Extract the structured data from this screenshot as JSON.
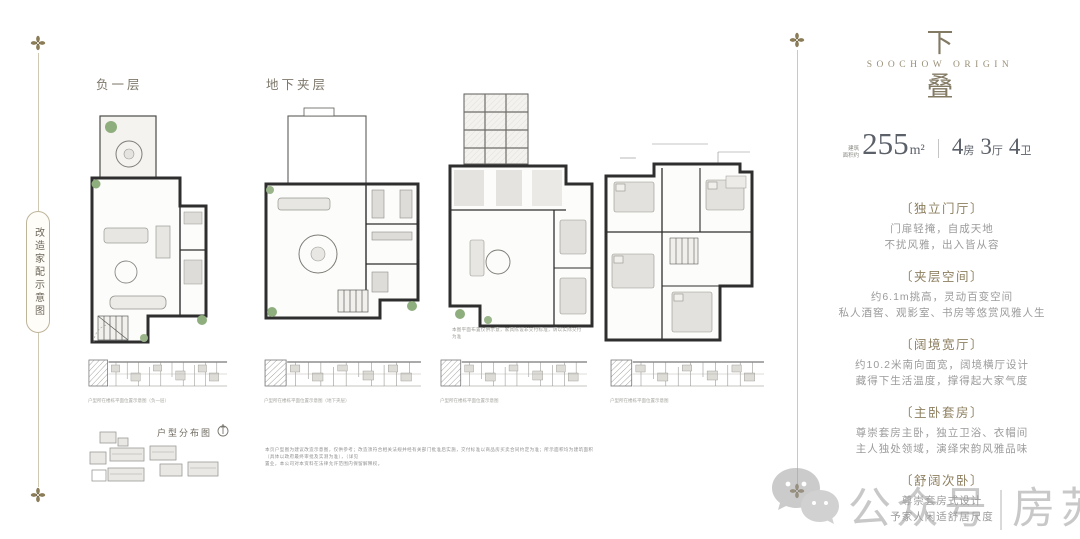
{
  "side_tag": {
    "label": "改造家配示意图"
  },
  "plans": {
    "b1_label": "负一层",
    "mezz_label": "地下夹层",
    "plan3_note": "本图平面布置仅供示意，家具陈设非交付标准，请以实际交付为准",
    "strip_captions": [
      "户型所在楼栋平面位置示意图（负一层）",
      "户型所在楼栋平面位置示意图（地下夹层）",
      "户型所在楼栋平面位置示意图",
      "户型所在楼栋平面位置示意图"
    ]
  },
  "site_map": {
    "title": "户型分布图"
  },
  "disclaimer": {
    "line1": "本页户型图为建议改造示意图，仅供参考；改造须符合相关法规并经有关部门批准后实施，交付标准以商品房买卖合同约定为准；所示面积均为建筑面积（具体以政府最终审批及实测为准），（详见",
    "line2": "置业，本公司对本资料在法律允许范围内保留解释权。"
  },
  "brand": {
    "char_top": "下",
    "subtitle": "SOOCHOW ORIGIN",
    "char_bottom": "叠"
  },
  "spec": {
    "area_prefix_line1": "建筑",
    "area_prefix_line2": "面积约",
    "area_value": "255",
    "area_unit": "m²",
    "divider": "|",
    "r1_num": "4",
    "r1_unit": "房",
    "r2_num": "3",
    "r2_unit": "厅",
    "r3_num": "4",
    "r3_unit": "卫"
  },
  "features": [
    {
      "title": "〔独立门厅〕",
      "line1": "门扉轻掩，自成天地",
      "line2": "不扰风雅，出入皆从容"
    },
    {
      "title": "〔夹层空间〕",
      "line1": "约6.1m挑高，灵动百变空间",
      "line2": "私人酒窖、观影室、书房等悠赏风雅人生"
    },
    {
      "title": "〔阔境宽厅〕",
      "line1": "约10.2米南向面宽，阔境横厅设计",
      "line2": "藏得下生活温度，撑得起大家气度"
    },
    {
      "title": "〔主卧套房〕",
      "line1": "尊崇套房主卧，独立卫浴、衣帽间",
      "line2": "主人独处领域，演绎宋韵风雅品味"
    },
    {
      "title": "〔舒阔次卧〕",
      "line1": "尊崇套房式设计",
      "line2": "予家人闲适舒居尺度"
    }
  ],
  "watermark": {
    "prefix": "公众号",
    "divider": "|",
    "name": "房苏州"
  },
  "colors": {
    "accent_gold": "#8b7c58",
    "title_bronze": "#8d7f5f",
    "body_gray": "#9b9b9b",
    "spec_dark": "#5b6069",
    "frame_line": "#cfc8b2",
    "plant_green": "#8fae7e",
    "watermark_gray": "#9c9c9c"
  }
}
